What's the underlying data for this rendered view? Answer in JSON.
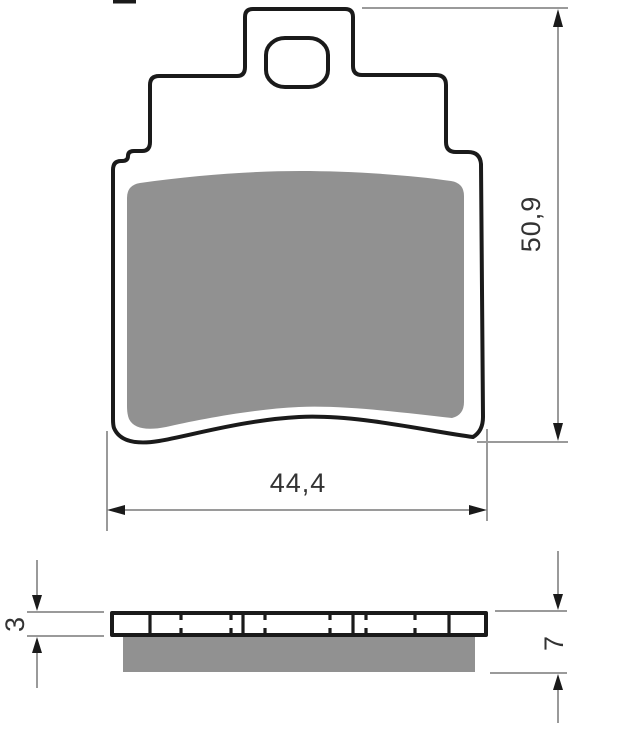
{
  "drawing": {
    "kind": "brake-pad-technical-drawing",
    "dimensions": {
      "pad_height": "50,9",
      "pad_width": "44,4",
      "backplate_thickness": "3",
      "total_thickness": "7"
    },
    "colors": {
      "outline": "#1a1a1a",
      "friction_material": "#919191",
      "dimension_line": "#9a9a9a",
      "arrow": "#1a1a1a",
      "dimension_text": "#333333",
      "background": "#ffffff"
    }
  }
}
